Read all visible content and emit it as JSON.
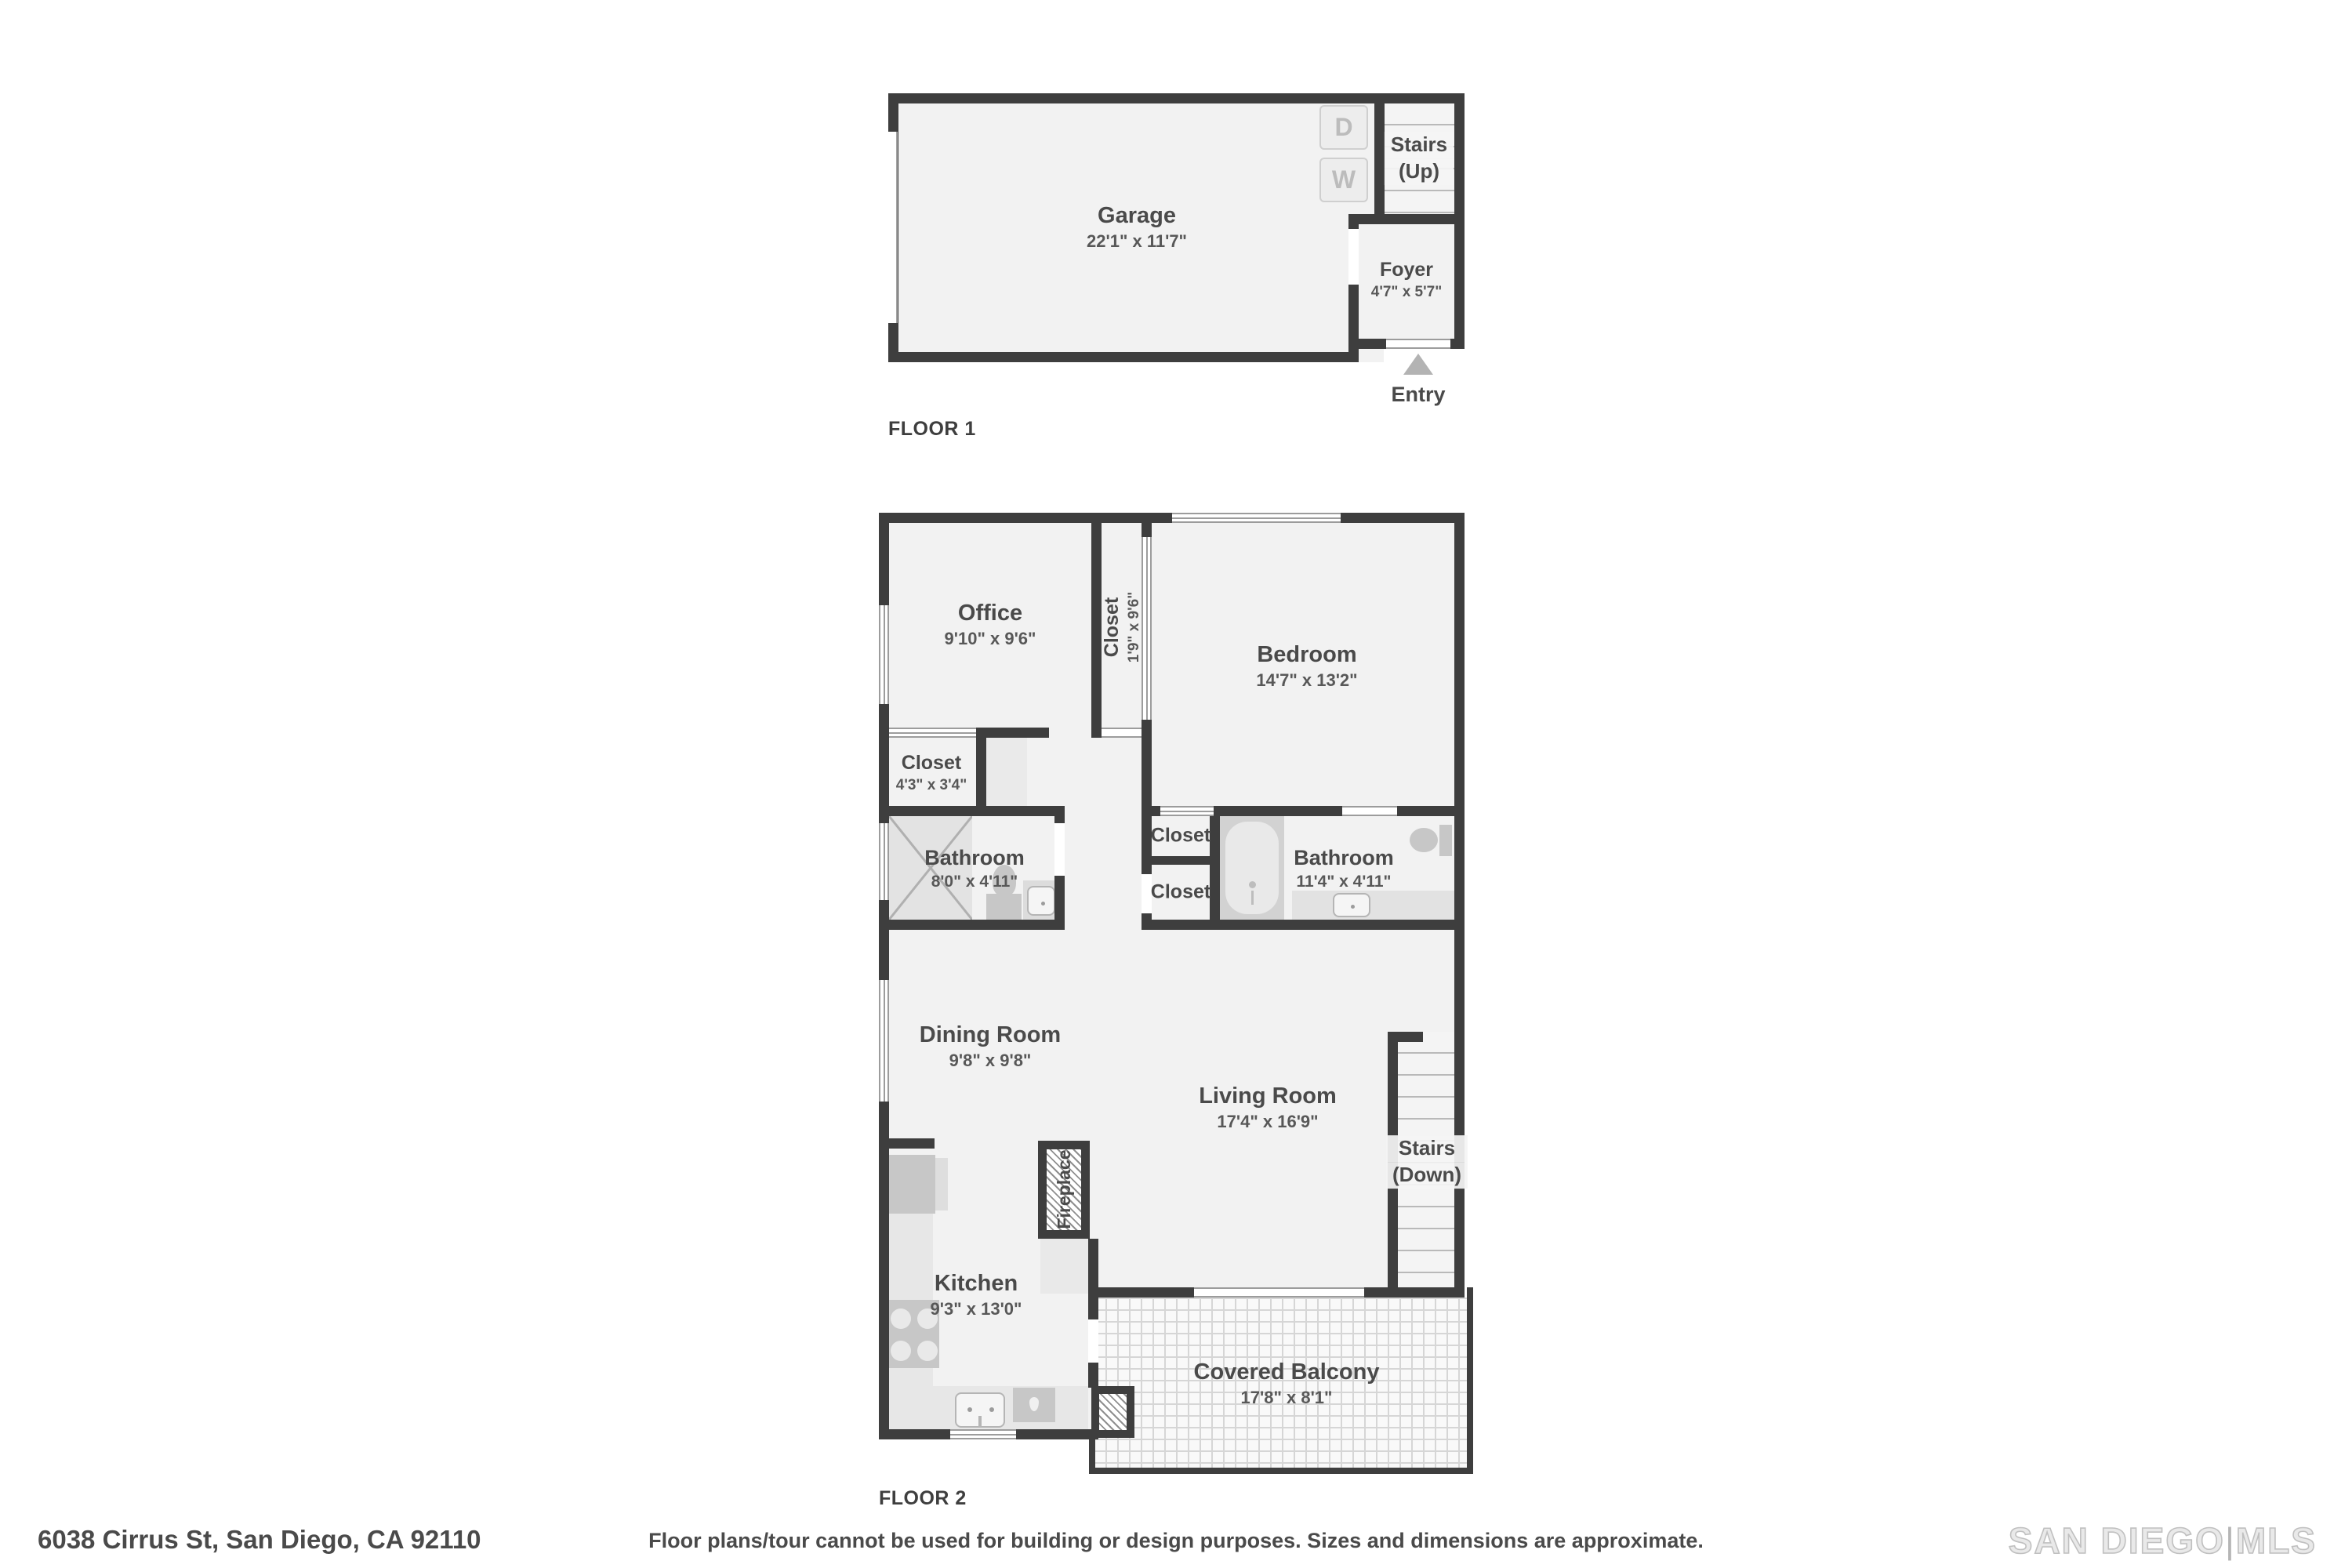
{
  "colors": {
    "wall": "#3e3e3e",
    "floor_fill": "#f2f2f2",
    "fixture": "#c7c7c7",
    "counter": "#e7e7e7",
    "text": "#4a4a4a",
    "tread_line": "#b9b9b9",
    "logo_gray": "#c0c0c0"
  },
  "floor1": {
    "label": "FLOOR 1",
    "garage": {
      "name": "Garage",
      "dims": "22'1\" x 11'7\""
    },
    "stairs_up": {
      "line1": "Stairs",
      "line2": "(Up)"
    },
    "foyer": {
      "name": "Foyer",
      "dims": "4'7\" x 5'7\""
    },
    "entry_label": "Entry",
    "dryer_label": "D",
    "washer_label": "W"
  },
  "floor2": {
    "label": "FLOOR 2",
    "office": {
      "name": "Office",
      "dims": "9'10\" x 9'6\""
    },
    "closet_tall": {
      "name": "Closet",
      "dims": "1'9\" x 9'6\""
    },
    "bedroom": {
      "name": "Bedroom",
      "dims": "14'7\" x 13'2\""
    },
    "closet_small": {
      "name": "Closet",
      "dims": "4'3\" x 3'4\""
    },
    "bathroom_left": {
      "name": "Bathroom",
      "dims": "8'0\" x 4'11\""
    },
    "closet_upper": {
      "name": "Closet"
    },
    "closet_lower": {
      "name": "Closet"
    },
    "bathroom_right": {
      "name": "Bathroom",
      "dims": "11'4\" x 4'11\""
    },
    "dining": {
      "name": "Dining Room",
      "dims": "9'8\" x 9'8\""
    },
    "living": {
      "name": "Living Room",
      "dims": "17'4\" x 16'9\""
    },
    "stairs_down": {
      "line1": "Stairs",
      "line2": "(Down)"
    },
    "fireplace_label": "Fireplace",
    "kitchen": {
      "name": "Kitchen",
      "dims": "9'3\" x 13'0\""
    },
    "balcony": {
      "name": "Covered Balcony",
      "dims": "17'8\" x 8'1\""
    }
  },
  "footer": {
    "address": "6038 Cirrus St, San Diego, CA 92110",
    "disclaimer": "Floor plans/tour cannot be used for building or design purposes. Sizes and dimensions are approximate.",
    "logo_primary": "SAN DIEGO",
    "logo_divider": "|",
    "logo_secondary": "MLS"
  }
}
